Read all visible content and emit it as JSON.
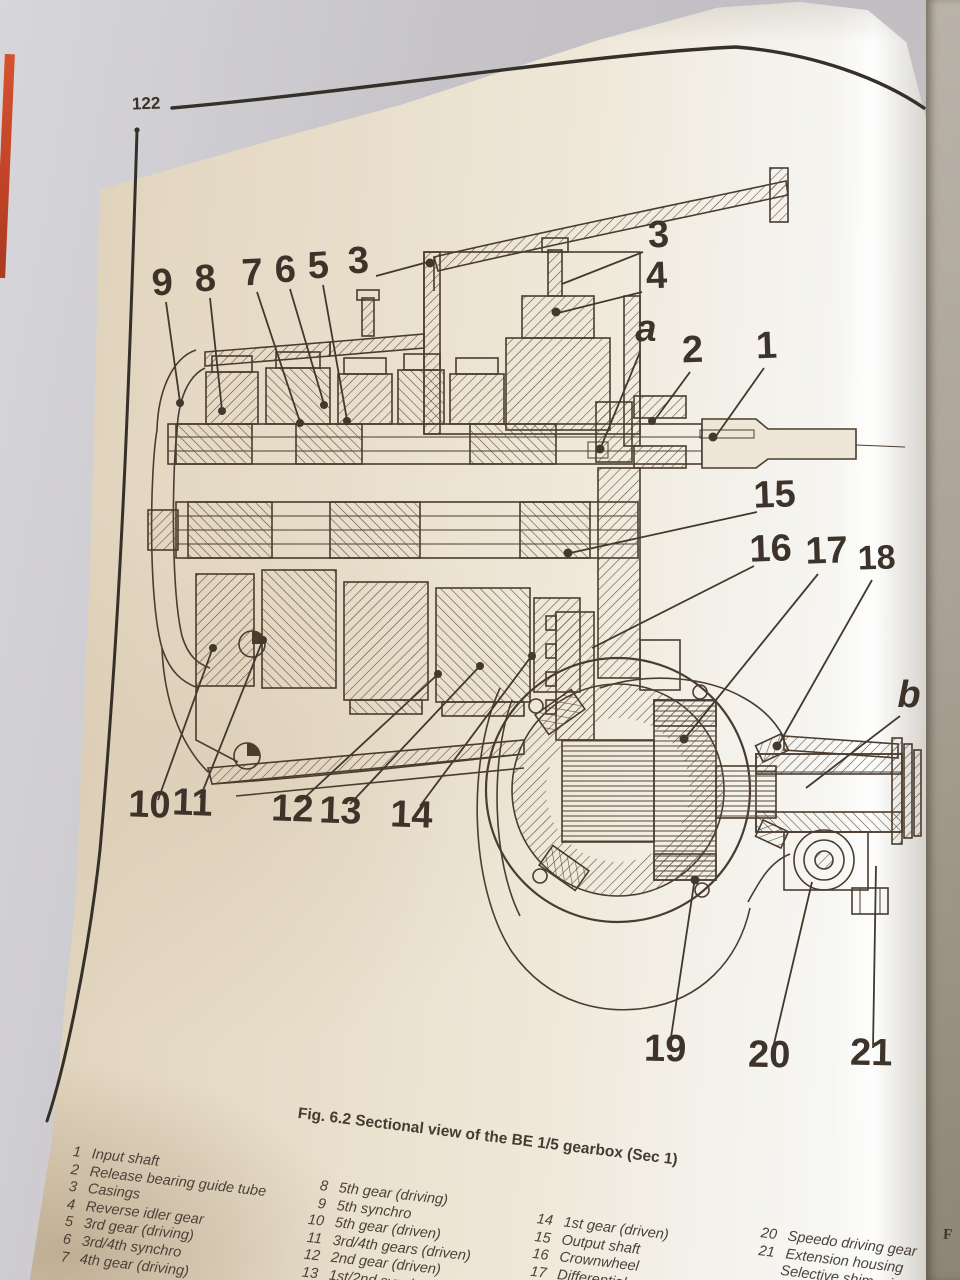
{
  "colors": {
    "ink": "#4a3c2f",
    "page_light": "#f7f7f4",
    "page_warm": "#dccdb4",
    "cover_red": "#c24427",
    "background_gray": "#c6c4c8",
    "edge_tan": "#c3a578"
  },
  "page": {
    "number": "122"
  },
  "figure": {
    "caption": "Fig. 6.2 Sectional view of the BE 1/5 gearbox (Sec 1)",
    "callouts": [
      "9",
      "8",
      "7",
      "6",
      "5",
      "3",
      "3",
      "4",
      "a",
      "2",
      "1",
      "15",
      "16",
      "17",
      "18",
      "b",
      "10",
      "11",
      "12",
      "13",
      "14",
      "19",
      "20",
      "21"
    ]
  },
  "legend": {
    "cols": [
      {
        "items": [
          {
            "num": "1",
            "label": "Input shaft"
          },
          {
            "num": "2",
            "label": "Release bearing guide tube"
          },
          {
            "num": "3",
            "label": "Casings"
          },
          {
            "num": "4",
            "label": "Reverse idler gear"
          },
          {
            "num": "5",
            "label": "3rd gear (driving)"
          },
          {
            "num": "6",
            "label": "3rd/4th synchro"
          },
          {
            "num": "7",
            "label": "4th gear (driving)"
          }
        ]
      },
      {
        "items": [
          {
            "num": "8",
            "label": "5th gear (driving)"
          },
          {
            "num": "9",
            "label": "5th synchro"
          },
          {
            "num": "10",
            "label": "5th gear (driven)"
          },
          {
            "num": "11",
            "label": "3rd/4th gears (driven)"
          },
          {
            "num": "12",
            "label": "2nd gear (driven)"
          },
          {
            "num": "13",
            "label": "1st/2nd synchro"
          }
        ]
      },
      {
        "items": [
          {
            "num": "14",
            "label": "1st gear (driven)"
          },
          {
            "num": "15",
            "label": "Output shaft"
          },
          {
            "num": "16",
            "label": "Crownwheel"
          },
          {
            "num": "17",
            "label": "Differential"
          }
        ]
      },
      {
        "items": [
          {
            "num": "20",
            "label": "Speedo driving gear"
          },
          {
            "num": "21",
            "label": "Extension housing"
          },
          {
            "num": "",
            "label": "Selective shim – input s"
          }
        ]
      }
    ]
  },
  "facing_page_fragment": "F"
}
